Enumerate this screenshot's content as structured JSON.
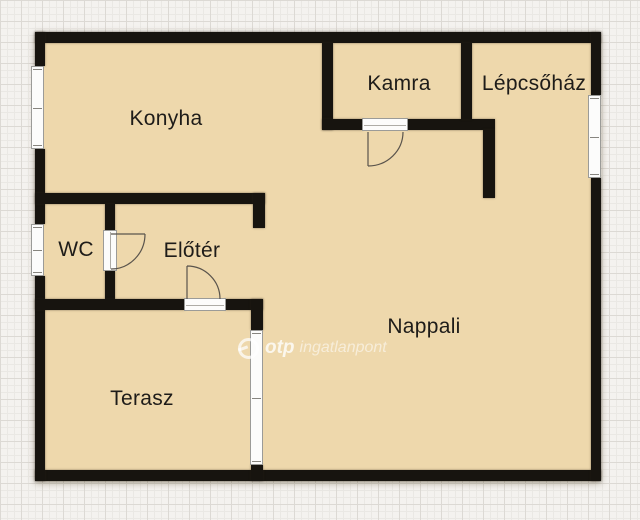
{
  "plan": {
    "rooms": {
      "konyha": {
        "label": "Konyha"
      },
      "kamra": {
        "label": "Kamra"
      },
      "lepcsohaz": {
        "label": "Lépcsőház"
      },
      "wc": {
        "label": "WC"
      },
      "eloter": {
        "label": "Előtér"
      },
      "nappali": {
        "label": "Nappali"
      },
      "terasz": {
        "label": "Terasz"
      }
    },
    "watermark": {
      "brand": "otp",
      "suffix": "ingatlanpont"
    },
    "colors": {
      "paper": "#f4f2ef",
      "grid_minor": "#eae8e4",
      "grid_major": "#dcd9d4",
      "floor": "#eed8ac",
      "wall": "#17140f",
      "label_text": "#1e1c19",
      "window_fill": "#fcfcfb",
      "window_frame": "#9b9b98",
      "watermark_white": "#ffffff"
    }
  }
}
